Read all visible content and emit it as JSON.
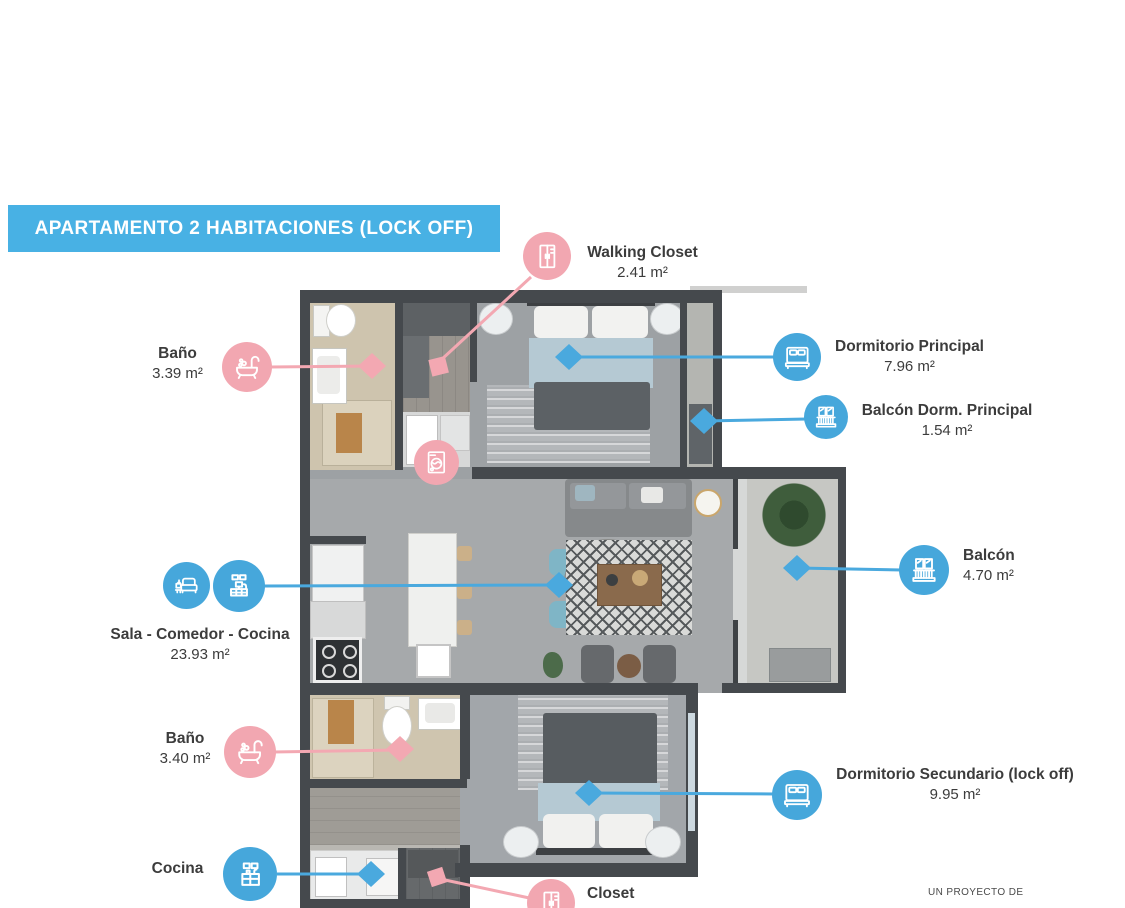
{
  "banner": {
    "title": "APARTAMENTO 2 HABITACIONES (LOCK OFF)"
  },
  "footer": {
    "project_note": "UN PROYECTO DE"
  },
  "colors": {
    "banner_blue": "#48b1e4",
    "icon_blue": "#46a7db",
    "icon_pink": "#f2a7b1",
    "label_text": "#3c3c3c",
    "wall_gray": "#45494d"
  },
  "callouts": [
    {
      "id": "walking-closet",
      "label": "Walking Closet",
      "area": "2.41 m²",
      "color": "pink",
      "icon": "wardrobe-icon"
    },
    {
      "id": "banio-principal",
      "label": "Baño",
      "area": "3.39 m²",
      "color": "pink",
      "icon": "bathtub-icon"
    },
    {
      "id": "dormitorio-principal",
      "label": "Dormitorio Principal",
      "area": "7.96 m²",
      "color": "blue",
      "icon": "bed-icon"
    },
    {
      "id": "balcon-dormitorio-principal",
      "label": "Balcón Dorm. Principal",
      "area": "1.54 m²",
      "color": "blue",
      "icon": "balcony-icon"
    },
    {
      "id": "balcon",
      "label": "Balcón",
      "area": "4.70 m²",
      "color": "blue",
      "icon": "balcony-icon"
    },
    {
      "id": "sala-comedor-cocina",
      "label": "Sala - Comedor - Cocina",
      "area": "23.93 m²",
      "color": "blue",
      "icons": [
        "sofa-icon",
        "tv-console-icon"
      ]
    },
    {
      "id": "banio-secundario",
      "label": "Baño",
      "area": "3.40 m²",
      "color": "pink",
      "icon": "bathtub-icon"
    },
    {
      "id": "dormitorio-secundario",
      "label": "Dormitorio Secundario (lock off)",
      "area": "9.95 m²",
      "color": "blue",
      "icon": "bed-icon"
    },
    {
      "id": "cocina",
      "label": "Cocina",
      "color": "blue",
      "icon": "kitchen-icon"
    },
    {
      "id": "closet",
      "label": "Closet",
      "color": "pink",
      "icon": "wardrobe-icon"
    }
  ],
  "plan_markers": {
    "washer_icon": "washing-machine-icon"
  }
}
